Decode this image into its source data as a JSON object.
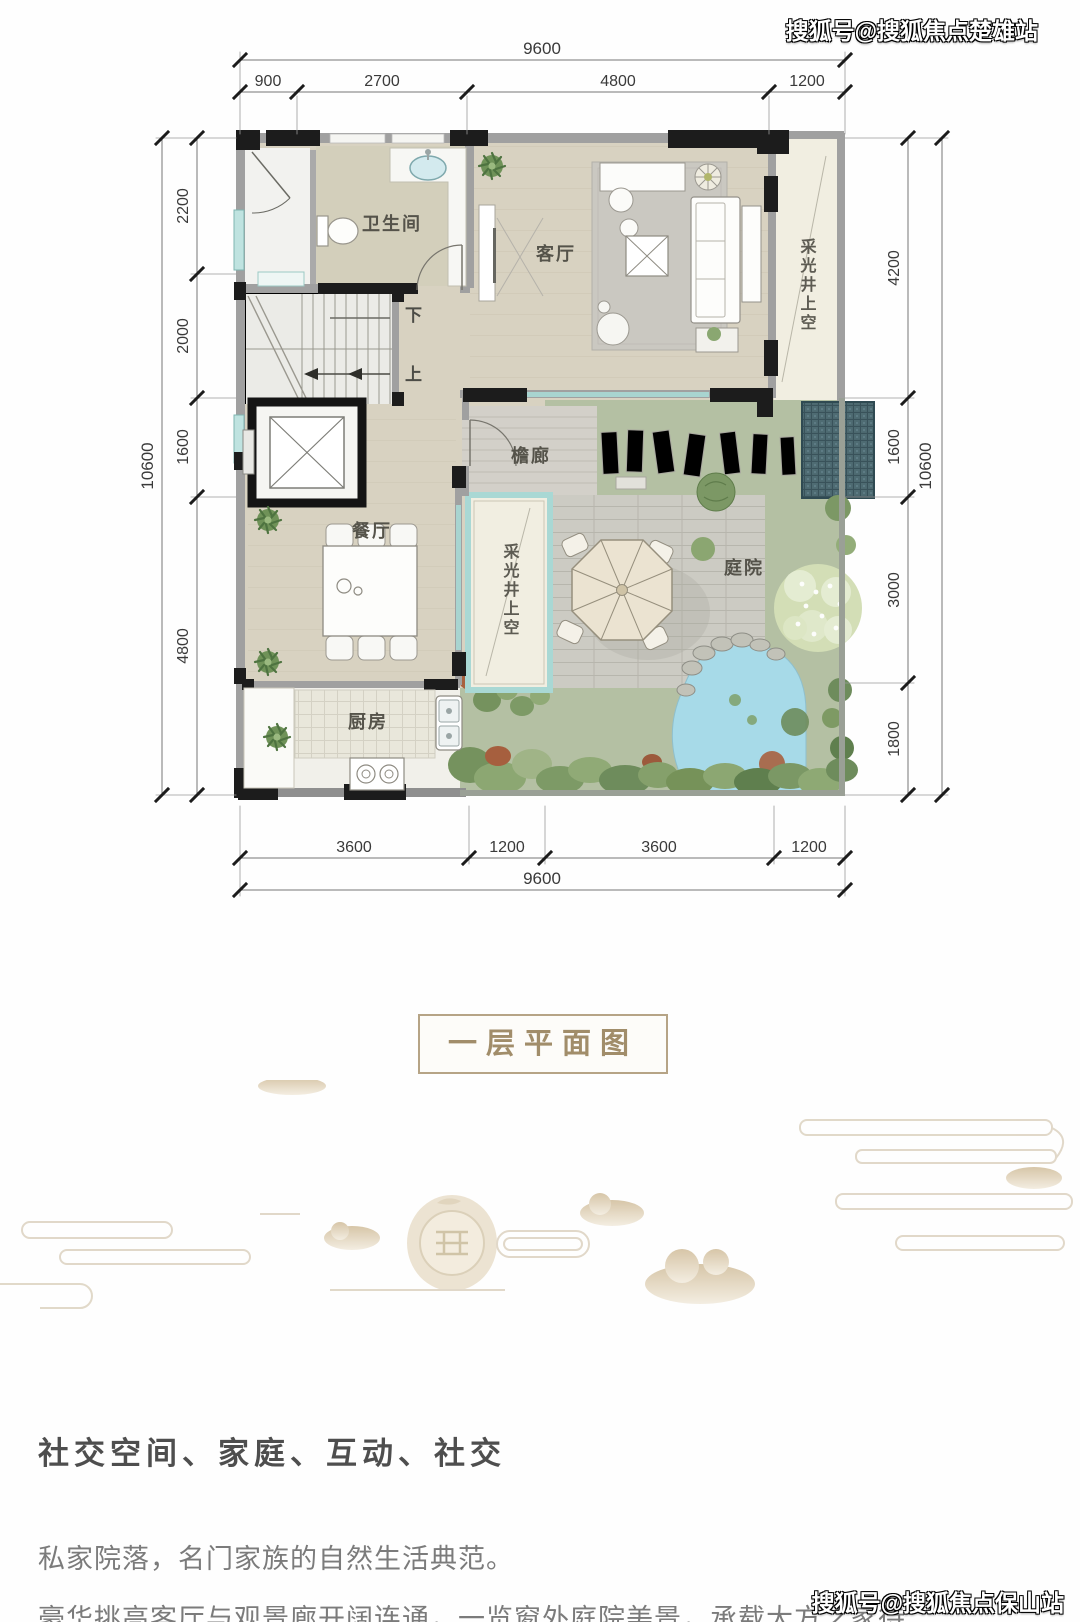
{
  "watermarks": {
    "top": "搜狐号@搜狐焦点楚雄站",
    "bottom": "搜狐号@搜狐焦点保山站"
  },
  "title": {
    "label": "一层平面图"
  },
  "floor_plan": {
    "rooms": {
      "bathroom": "卫生间",
      "living_room": "客厅",
      "light_well_right": "采光井上空",
      "eaves_corridor": "檐廊",
      "dining_room": "餐厅",
      "light_well_center": "采光井上空",
      "courtyard": "庭院",
      "kitchen": "厨房",
      "stair_down": "下",
      "stair_up": "上"
    },
    "dimensions": {
      "top": {
        "total": "9600",
        "segments": [
          "900",
          "2700",
          "4800",
          "1200"
        ]
      },
      "bottom": {
        "total": "9600",
        "segments": [
          "3600",
          "1200",
          "3600",
          "1200"
        ]
      },
      "left": {
        "total": "10600",
        "segments": [
          "2200",
          "2000",
          "1600",
          "4800"
        ]
      },
      "right": {
        "total": "10600",
        "segments": [
          "4200",
          "1600",
          "3000",
          "1800"
        ]
      }
    }
  },
  "description": {
    "heading": "社交空间、家庭、互动、社交",
    "paragraphs": [
      "私家院落，名门家族的自然生活典范。",
      "豪华挑高客厅与观景廊开阔连通，一览窗外庭院美景，承载大方之家待"
    ]
  },
  "colors": {
    "accent_tan": "#a18d6a",
    "wall_dark": "#1c1c1c",
    "wall_gray": "#a0a0a0",
    "floor_beige": "#d8d2c1",
    "courtyard_green": "#b4c0a3",
    "pond_blue": "#a7dae8",
    "roof_teal": "#4e6b72",
    "glass_cyan": "#a8d4d0",
    "heading_text": "#4e4e4e",
    "body_text": "#7b7b7b"
  }
}
